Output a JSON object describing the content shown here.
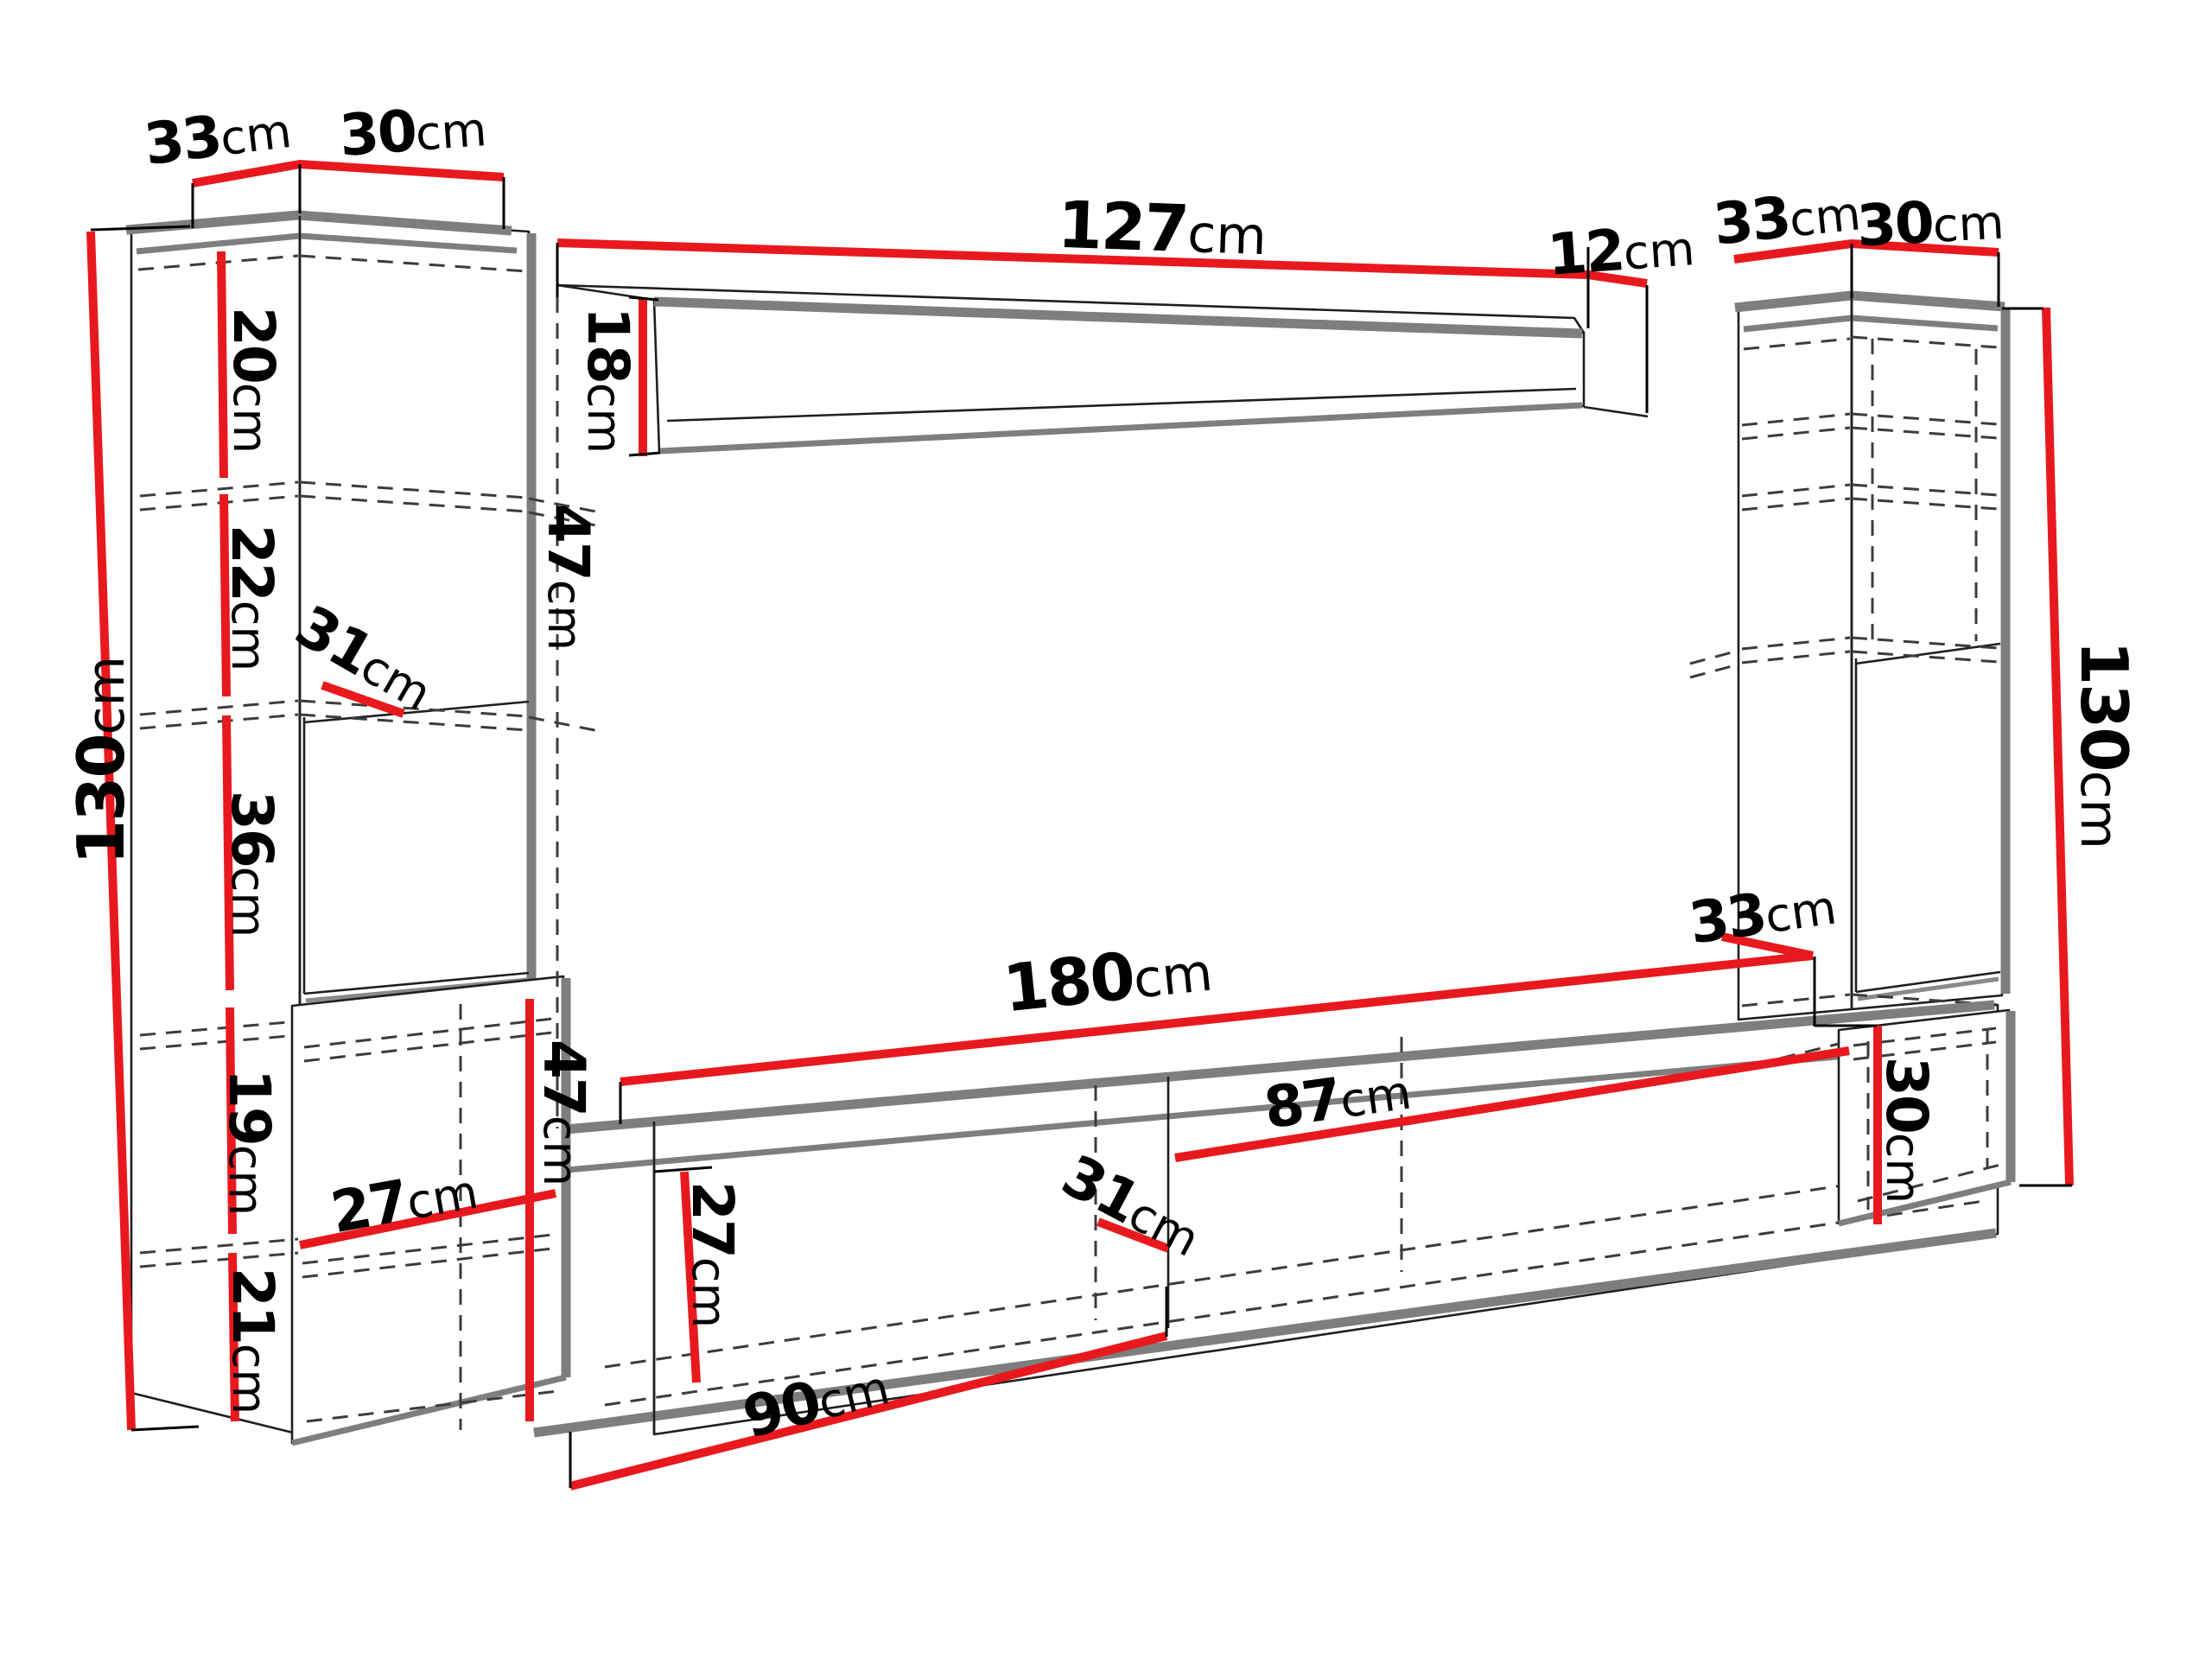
{
  "diagram_type": "furniture wall-unit dimension drawing",
  "units": "cm",
  "colors": {
    "dimension_line": "#e8191e",
    "outline": "#1f1f1f",
    "shadow_edge": "#7e7e7e",
    "background": "#ffffff",
    "label_text": "#000000"
  },
  "labels": {
    "left_cabinet_top_depth": {
      "value": "33",
      "unit": "cm"
    },
    "left_cabinet_top_width": {
      "value": "30",
      "unit": "cm"
    },
    "left_cabinet_section_1": {
      "value": "20",
      "unit": "cm"
    },
    "left_cabinet_section_2": {
      "value": "22",
      "unit": "cm"
    },
    "left_cabinet_shelf_depth": {
      "value": "31",
      "unit": "cm"
    },
    "left_cabinet_section_3": {
      "value": "36",
      "unit": "cm"
    },
    "left_cabinet_section_4": {
      "value": "19",
      "unit": "cm"
    },
    "left_cabinet_inner_width": {
      "value": "27",
      "unit": "cm"
    },
    "left_cabinet_section_5": {
      "value": "21",
      "unit": "cm"
    },
    "left_cabinet_height": {
      "value": "130",
      "unit": "cm"
    },
    "left_cabinet_door_height": {
      "value": "47",
      "unit": "cm"
    },
    "shelf_clearance": {
      "value": "47",
      "unit": "cm"
    },
    "wall_shelf_height": {
      "value": "18",
      "unit": "cm"
    },
    "wall_shelf_width": {
      "value": "127",
      "unit": "cm"
    },
    "wall_shelf_depth": {
      "value": "12",
      "unit": "cm"
    },
    "right_cabinet_top_depth": {
      "value": "33",
      "unit": "cm"
    },
    "right_cabinet_top_width": {
      "value": "30",
      "unit": "cm"
    },
    "right_cabinet_height": {
      "value": "130",
      "unit": "cm"
    },
    "right_cabinet_bottom_depth": {
      "value": "33",
      "unit": "cm"
    },
    "right_cabinet_bottom_height": {
      "value": "30",
      "unit": "cm"
    },
    "tv_stand_width": {
      "value": "180",
      "unit": "cm"
    },
    "tv_stand_inner_height": {
      "value": "27",
      "unit": "cm"
    },
    "tv_stand_inner_depth": {
      "value": "31",
      "unit": "cm"
    },
    "tv_stand_inner_width": {
      "value": "87",
      "unit": "cm"
    },
    "tv_stand_bottom_width": {
      "value": "90",
      "unit": "cm"
    }
  },
  "components": {
    "left_cabinet": {
      "height": "130cm",
      "top_depth": "33cm",
      "top_width": "30cm",
      "sections": [
        "20cm",
        "22cm",
        "36cm",
        "19cm",
        "21cm"
      ],
      "inner_width": "27cm",
      "shelf_depth": "31cm",
      "lower_door_height": "47cm"
    },
    "wall_shelf": {
      "width": "127cm",
      "end_depth": "12cm",
      "front_height": "18cm",
      "clearance": "47cm"
    },
    "right_cabinet": {
      "height": "130cm",
      "top_depth": "33cm",
      "top_width": "30cm",
      "bottom_depth": "33cm",
      "bottom_height": "30cm"
    },
    "tv_stand": {
      "width": "180cm",
      "inner_height": "27cm",
      "inner_width": "87cm",
      "inner_depth": "31cm",
      "bottom_left_width": "90cm"
    }
  }
}
